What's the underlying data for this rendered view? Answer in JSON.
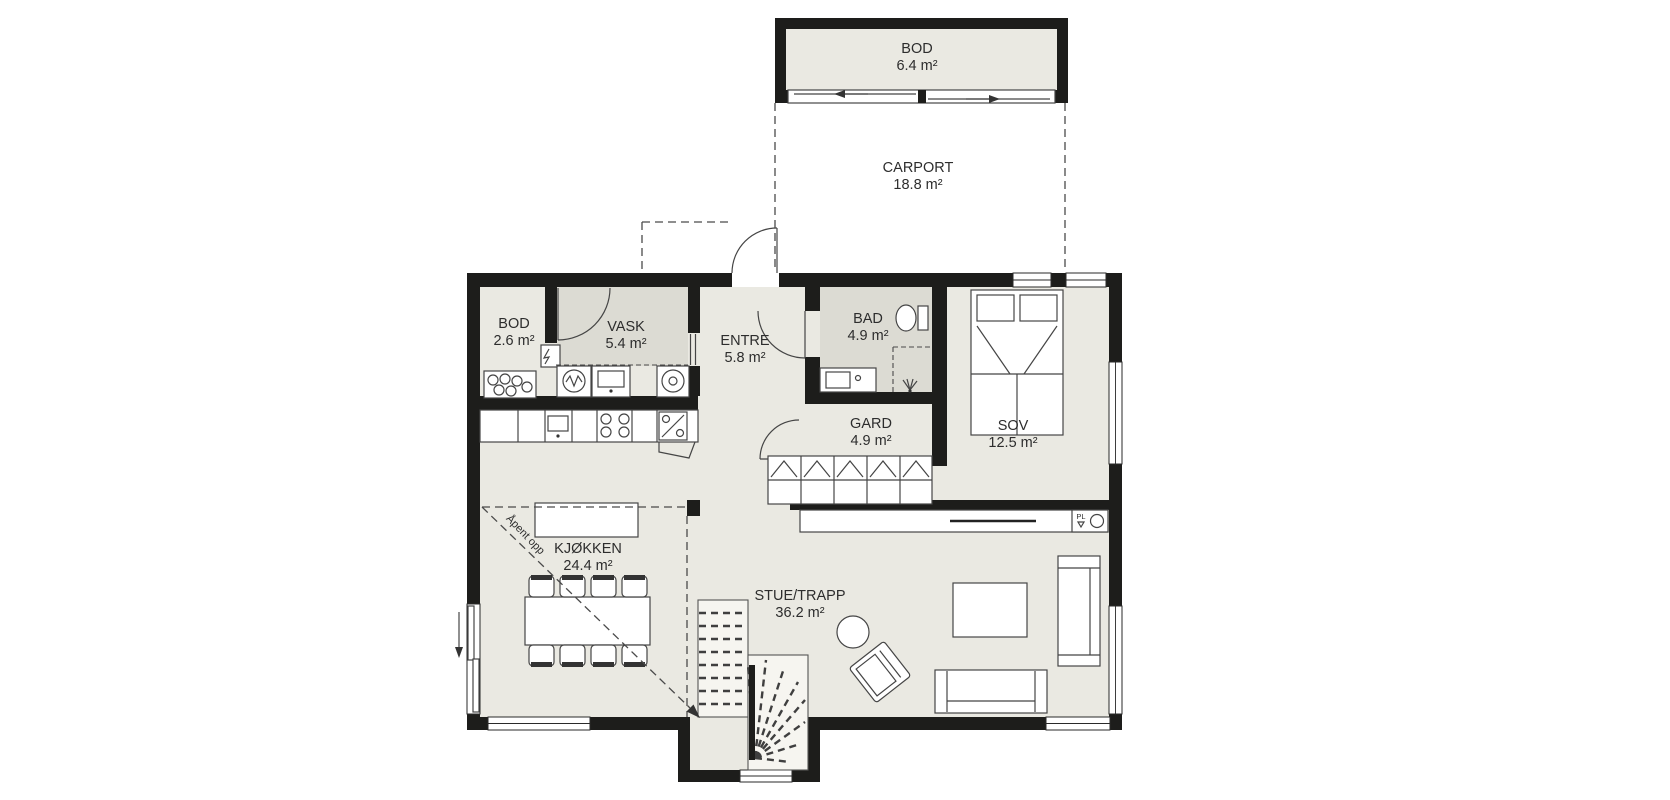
{
  "colors": {
    "wall": "#1d1d1b",
    "floor": "#eae9e2",
    "floor_dark": "#dcdbd3",
    "line": "#454545",
    "text": "#2d2d2d",
    "background": "#ffffff"
  },
  "rooms": [
    {
      "name": "BOD",
      "area": "6.4 m²"
    },
    {
      "name": "CARPORT",
      "area": "18.8 m²"
    },
    {
      "name": "BOD",
      "area": "2.6 m²"
    },
    {
      "name": "VASK",
      "area": "5.4 m²"
    },
    {
      "name": "ENTRE",
      "area": "5.8 m²"
    },
    {
      "name": "BAD",
      "area": "4.9 m²"
    },
    {
      "name": "GARD",
      "area": "4.9 m²"
    },
    {
      "name": "SOV",
      "area": "12.5 m²"
    },
    {
      "name": "KJØKKEN",
      "area": "24.4 m²"
    },
    {
      "name": "STUE/TRAPP",
      "area": "36.2 m²"
    }
  ],
  "annotations": {
    "open_above": "Åpent opp",
    "tech_cabinet": "PL"
  }
}
